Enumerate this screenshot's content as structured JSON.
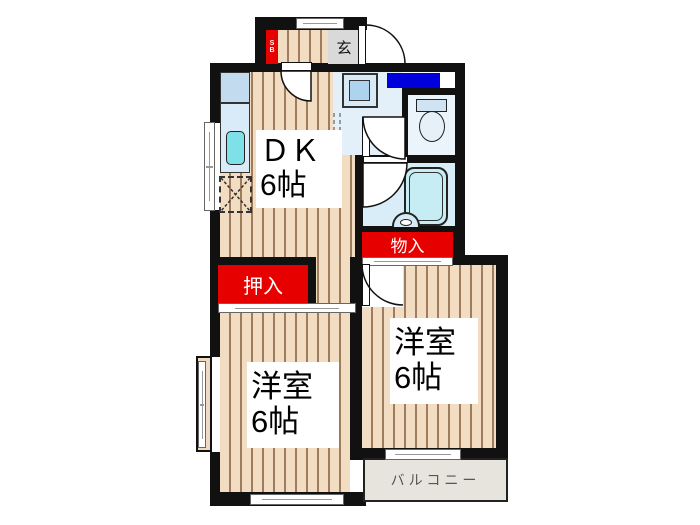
{
  "floor_plan": {
    "title": "2DK apartment floor plan",
    "rooms": {
      "dk": {
        "name": "ＤＫ",
        "size": "6帖"
      },
      "bedroom_left": {
        "name": "洋室",
        "size": "6帖"
      },
      "bedroom_right": {
        "name": "洋室",
        "size": "6帖"
      }
    },
    "labels": {
      "entrance": "玄",
      "shoe_box": "SB",
      "closet": "押入",
      "storage": "物入",
      "balcony": "バルコニー"
    },
    "colors": {
      "wall": "#111111",
      "floor_plank": "#f2dcc2",
      "floor_stripe": "#9e7c5e",
      "closet_red": "#e60000",
      "counter_blue": "#0000dd",
      "wet_floor": "#e3eff9",
      "bathtub": "#c6edf3",
      "sink_cyan": "#7ee1e8",
      "balcony_gray": "#e7e4dd",
      "genkan_gray": "#d9d9d9"
    }
  }
}
